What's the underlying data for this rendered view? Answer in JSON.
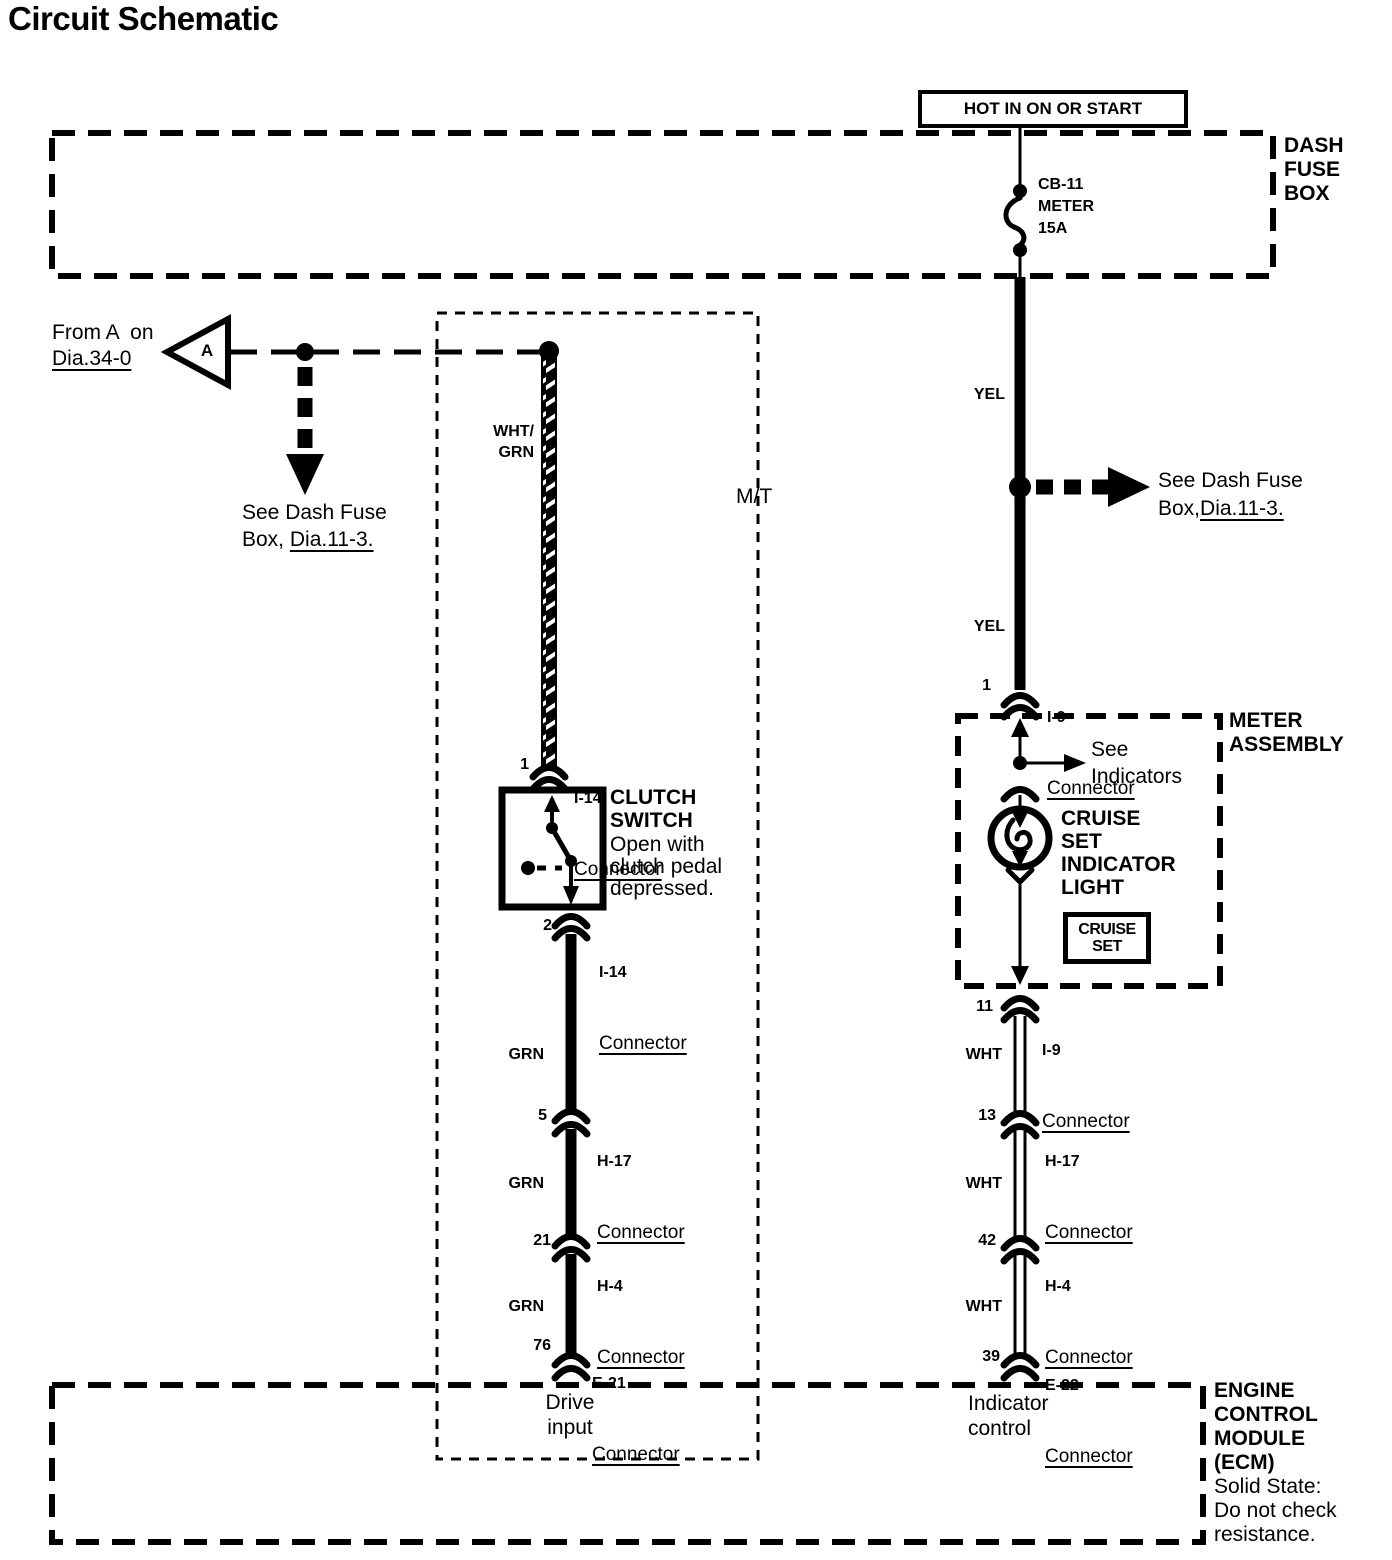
{
  "title": "Circuit Schematic",
  "power_source": {
    "label": "HOT IN ON OR START"
  },
  "dash_fuse_box": {
    "label": "DASH\nFUSE\nBOX"
  },
  "fuse": {
    "label": "CB-11\nMETER\n15A"
  },
  "from_ref": {
    "text": "From A  on",
    "link": "Dia.34-0",
    "symbol": "A"
  },
  "see_ref_left": {
    "line1": "See Dash Fuse",
    "line2_prefix": "Box, ",
    "link": "Dia.11-3."
  },
  "see_ref_right": {
    "line1": "See Dash Fuse",
    "line2_prefix": "Box,",
    "link": "Dia.11-3."
  },
  "mt_region": {
    "label": "M/T",
    "footer": "Drive\ninput"
  },
  "wire_labels": {
    "wht_grn": "WHT/\nGRN",
    "yel_upper": "YEL",
    "yel_lower": "YEL",
    "grn_1": "GRN",
    "grn_2": "GRN",
    "grn_3": "GRN",
    "wht_1": "WHT",
    "wht_2": "WHT",
    "wht_3": "WHT"
  },
  "connectors": {
    "i14_top": {
      "pin": "1",
      "id": "I-14",
      "word": "Connector"
    },
    "i14_bottom": {
      "pin": "2",
      "id": "I-14",
      "word": "Connector"
    },
    "h17_left": {
      "pin": "5",
      "id": "H-17",
      "word": "Connector"
    },
    "h4_left": {
      "pin": "21",
      "id": "H-4",
      "word": "Connector"
    },
    "e21": {
      "pin": "76",
      "id": "E-21",
      "word": "Connector"
    },
    "i9_top": {
      "pin": "1",
      "id": "I-9",
      "word": "Connector"
    },
    "i9_bottom": {
      "pin": "11",
      "id": "I-9",
      "word": "Connector"
    },
    "h17_right": {
      "pin": "13",
      "id": "H-17",
      "word": "Connector"
    },
    "h4_right": {
      "pin": "42",
      "id": "H-4",
      "word": "Connector"
    },
    "e22": {
      "pin": "39",
      "id": "E-22",
      "word": "Connector"
    }
  },
  "clutch_switch": {
    "name": "CLUTCH\nSWITCH",
    "note": "Open with\nclutch pedal\ndepressed."
  },
  "meter_assembly": {
    "label": "METER\nASSEMBLY"
  },
  "see_indicators": {
    "text": "See\nIndicators"
  },
  "cruise_indicator": {
    "label": "CRUISE\nSET\nINDICATOR\nLIGHT",
    "badge": "CRUISE\nSET"
  },
  "ecm": {
    "name": "ENGINE\nCONTROL\nMODULE\n(ECM)",
    "note": "Solid State:\nDo not check\nresistance.",
    "footer": "Indicator\ncontrol"
  },
  "colors": {
    "ink": "#000000",
    "paper": "#ffffff"
  }
}
